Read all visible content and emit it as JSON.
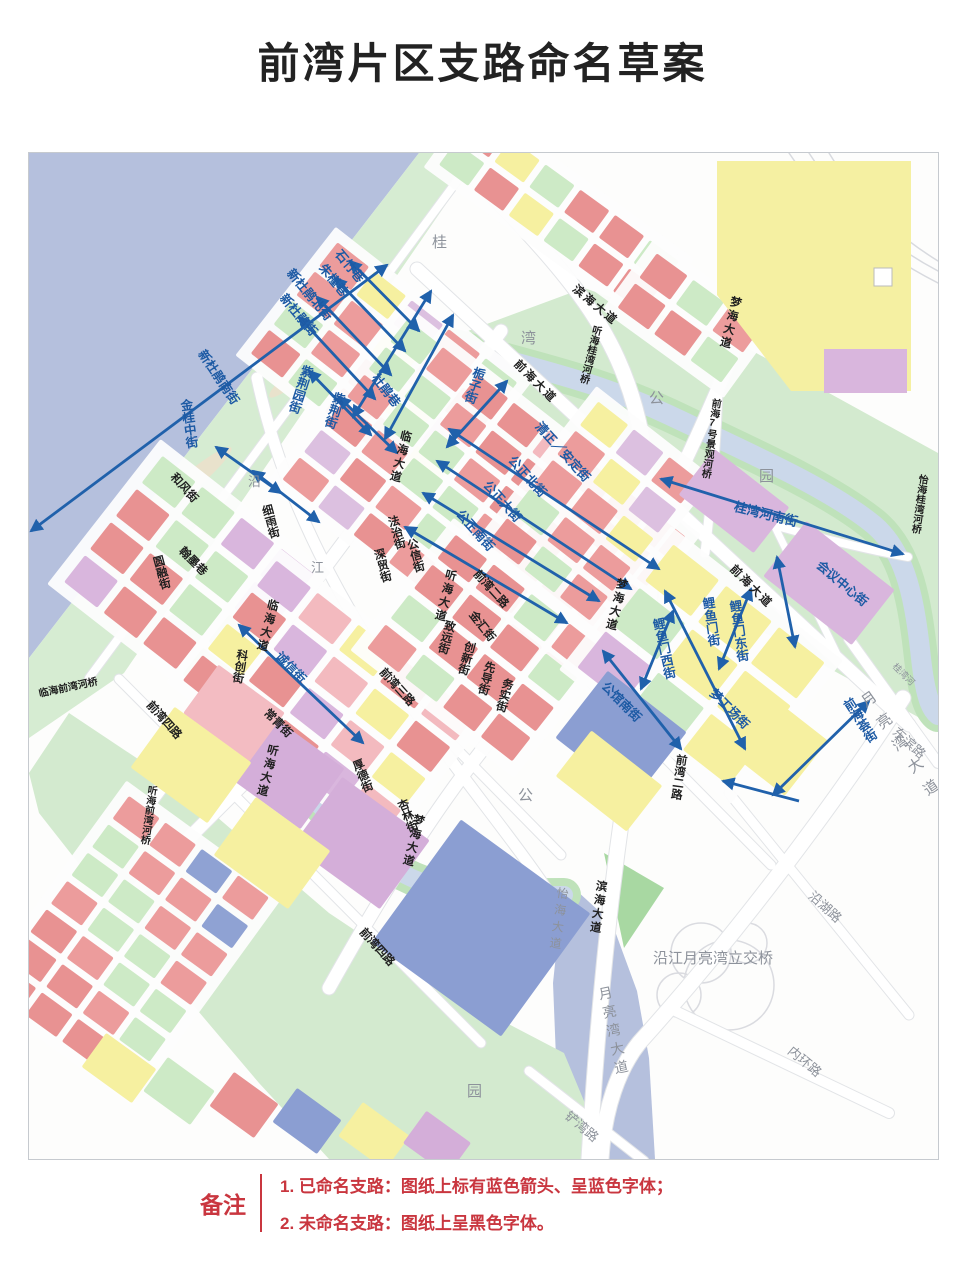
{
  "title": "前湾片区支路命名草案",
  "notes": {
    "label": "备注",
    "items": [
      "1. 已命名支路：图纸上标有蓝色箭头、呈蓝色字体；",
      "2. 未命名支路：图纸上呈黑色字体。"
    ]
  },
  "colors": {
    "named_road_text": "#1d5aa4",
    "arrow_blue": "#2061ab",
    "unnamed_road_text": "#1f1f1f",
    "existing_road_text": "#8d929b",
    "note_red": "#c9363f",
    "sea": "#b5c0dd",
    "park_green": "#d3eacf",
    "block_red": "#e89292",
    "block_yellow": "#f6f0a0",
    "block_purple": "#d9b6dd",
    "block_blue": "#8b9ed2"
  },
  "map": {
    "offset_x": 28,
    "offset_y": 152,
    "width": 909,
    "height": 1006,
    "labels": [
      {
        "t": "石竹巷",
        "x": 341,
        "y": 247,
        "r": 50,
        "c": "n"
      },
      {
        "t": "朱槿巷",
        "x": 325,
        "y": 261,
        "r": 50,
        "c": "n"
      },
      {
        "t": "新杜鹃北街",
        "x": 293,
        "y": 266,
        "r": 50,
        "c": "n"
      },
      {
        "t": "新杜鹃街",
        "x": 286,
        "y": 291,
        "r": 50,
        "c": "n"
      },
      {
        "t": "新杜鹃南街",
        "x": 205,
        "y": 347,
        "r": 56,
        "c": "n"
      },
      {
        "t": "金桂中街",
        "x": 177,
        "y": 398,
        "r": -8,
        "c": "n",
        "m": "v"
      },
      {
        "t": "紫荆园街",
        "x": 300,
        "y": 364,
        "r": 18,
        "c": "n",
        "m": "v"
      },
      {
        "t": "紫荆街",
        "x": 332,
        "y": 391,
        "r": 18,
        "c": "n",
        "m": "v"
      },
      {
        "t": "杜鹃巷",
        "x": 378,
        "y": 371,
        "r": 52,
        "c": "n"
      },
      {
        "t": "栀子街",
        "x": 472,
        "y": 366,
        "r": 18,
        "c": "n",
        "m": "v"
      },
      {
        "t": "清正／安定街",
        "x": 541,
        "y": 419,
        "r": 48,
        "c": "n"
      },
      {
        "t": "公正北街",
        "x": 514,
        "y": 453,
        "r": 48,
        "c": "n"
      },
      {
        "t": "公正大街",
        "x": 489,
        "y": 478,
        "r": 48,
        "c": "n"
      },
      {
        "t": "公正南街",
        "x": 462,
        "y": 507,
        "r": 48,
        "c": "n"
      },
      {
        "t": "诚信街",
        "x": 281,
        "y": 649,
        "r": 46,
        "c": "n"
      },
      {
        "t": "桂湾河南街",
        "x": 735,
        "y": 499,
        "r": 14,
        "c": "n",
        "s": 13
      },
      {
        "t": "会议中心街",
        "x": 821,
        "y": 558,
        "r": 40,
        "c": "n"
      },
      {
        "t": "鲤鱼门西街",
        "x": 649,
        "y": 617,
        "r": -12,
        "c": "n",
        "m": "v"
      },
      {
        "t": "鲤鱼门街",
        "x": 699,
        "y": 596,
        "r": -8,
        "c": "n",
        "m": "v"
      },
      {
        "t": "鲤鱼门东街",
        "x": 726,
        "y": 599,
        "r": -8,
        "c": "n",
        "m": "v"
      },
      {
        "t": "公馆南街",
        "x": 607,
        "y": 679,
        "r": 45,
        "c": "n"
      },
      {
        "t": "梦工场街",
        "x": 715,
        "y": 686,
        "r": 45,
        "c": "n"
      },
      {
        "t": "前海荟街",
        "x": 838,
        "y": 699,
        "r": -33,
        "c": "n",
        "m": "v"
      },
      {
        "t": "和风街",
        "x": 175,
        "y": 471,
        "r": 48,
        "c": "u"
      },
      {
        "t": "细雨街",
        "x": 258,
        "y": 504,
        "r": -15,
        "c": "u",
        "m": "v"
      },
      {
        "t": "翰墨巷",
        "x": 183,
        "y": 545,
        "r": 45,
        "c": "u"
      },
      {
        "t": "圆融街",
        "x": 149,
        "y": 555,
        "r": -15,
        "c": "u",
        "m": "v"
      },
      {
        "t": "法治街",
        "x": 384,
        "y": 515,
        "r": -15,
        "c": "u",
        "m": "v"
      },
      {
        "t": "深贸街",
        "x": 370,
        "y": 548,
        "r": -15,
        "c": "u",
        "m": "v"
      },
      {
        "t": "公信街",
        "x": 403,
        "y": 538,
        "r": -15,
        "c": "u",
        "m": "v"
      },
      {
        "t": "金汇街",
        "x": 474,
        "y": 609,
        "r": 52,
        "c": "u"
      },
      {
        "t": "致远街",
        "x": 443,
        "y": 619,
        "r": 15,
        "c": "u",
        "m": "v"
      },
      {
        "t": "创新街",
        "x": 463,
        "y": 640,
        "r": 15,
        "c": "u",
        "m": "v"
      },
      {
        "t": "先导街",
        "x": 483,
        "y": 660,
        "r": 15,
        "c": "u",
        "m": "v"
      },
      {
        "t": "务实街",
        "x": 501,
        "y": 677,
        "r": 15,
        "c": "u",
        "m": "v"
      },
      {
        "t": "科创街",
        "x": 235,
        "y": 648,
        "r": 10,
        "c": "u",
        "m": "v"
      },
      {
        "t": "常青街",
        "x": 268,
        "y": 707,
        "r": 45,
        "c": "u"
      },
      {
        "t": "厚德街",
        "x": 348,
        "y": 759,
        "r": -22,
        "c": "u",
        "m": "v"
      },
      {
        "t": "杏林街",
        "x": 393,
        "y": 799,
        "r": -22,
        "c": "u",
        "m": "v"
      },
      {
        "t": "前湾二路",
        "x": 478,
        "y": 568,
        "r": 48,
        "c": "u"
      },
      {
        "t": "前湾二路",
        "x": 674,
        "y": 753,
        "r": 8,
        "c": "u",
        "m": "v"
      },
      {
        "t": "前湾三路",
        "x": 384,
        "y": 666,
        "r": 48,
        "c": "u"
      },
      {
        "t": "前湾四路",
        "x": 151,
        "y": 699,
        "r": 48,
        "c": "u"
      },
      {
        "t": "前湾四路",
        "x": 364,
        "y": 926,
        "r": 48,
        "c": "u"
      },
      {
        "t": "临海大道",
        "x": 399,
        "y": 429,
        "r": 14,
        "c": "u",
        "m": "v",
        "ls": 0.2
      },
      {
        "t": "临海大道",
        "x": 266,
        "y": 598,
        "r": 14,
        "c": "u",
        "m": "v",
        "ls": 0.2
      },
      {
        "t": "听海大道",
        "x": 444,
        "y": 568,
        "r": 14,
        "c": "u",
        "m": "v",
        "ls": 0.2
      },
      {
        "t": "听海大道",
        "x": 266,
        "y": 743,
        "r": 14,
        "c": "u",
        "m": "v",
        "ls": 0.2
      },
      {
        "t": "前海大道",
        "x": 518,
        "y": 358,
        "r": 45,
        "c": "u",
        "ls": 0.2
      },
      {
        "t": "前海大道",
        "x": 734,
        "y": 563,
        "r": 45,
        "c": "u",
        "ls": 0.2
      },
      {
        "t": "梦海大道",
        "x": 729,
        "y": 295,
        "r": 14,
        "c": "u",
        "m": "v",
        "ls": 0.2
      },
      {
        "t": "梦海大道",
        "x": 615,
        "y": 577,
        "r": 14,
        "c": "u",
        "m": "v",
        "ls": 0.2
      },
      {
        "t": "梦海大道",
        "x": 412,
        "y": 813,
        "r": 14,
        "c": "u",
        "m": "v",
        "ls": 0.2
      },
      {
        "t": "滨海大道",
        "x": 576,
        "y": 283,
        "r": 40,
        "c": "u",
        "ls": 0.2
      },
      {
        "t": "滨海大道",
        "x": 594,
        "y": 879,
        "r": 8,
        "c": "u",
        "m": "v",
        "ls": 0.2
      },
      {
        "t": "听海桂湾河桥",
        "x": 590,
        "y": 324,
        "r": 14,
        "c": "u",
        "m": "v",
        "s": 10
      },
      {
        "t": "怡海桂湾河桥",
        "x": 916,
        "y": 473,
        "r": 8,
        "c": "u",
        "m": "v",
        "s": 10
      },
      {
        "t": "前海7号景观河桥",
        "x": 709,
        "y": 397,
        "r": 8,
        "c": "u",
        "m": "v",
        "s": 10
      },
      {
        "t": "临海前湾河桥",
        "x": 37,
        "y": 689,
        "r": -12,
        "c": "u",
        "s": 10
      },
      {
        "t": "听海前湾河桥",
        "x": 145,
        "y": 784,
        "r": 8,
        "c": "u",
        "m": "v",
        "s": 10
      },
      {
        "t": "桂",
        "x": 431,
        "y": 234,
        "r": 0,
        "c": "e",
        "s": 15
      },
      {
        "t": "湾",
        "x": 520,
        "y": 330,
        "r": 0,
        "c": "e",
        "s": 15
      },
      {
        "t": "公",
        "x": 648,
        "y": 390,
        "r": 0,
        "c": "e",
        "s": 15
      },
      {
        "t": "园",
        "x": 758,
        "y": 468,
        "r": 0,
        "c": "e",
        "s": 15
      },
      {
        "t": "公",
        "x": 517,
        "y": 787,
        "r": 0,
        "c": "e",
        "s": 15
      },
      {
        "t": "园",
        "x": 466,
        "y": 1083,
        "r": 0,
        "c": "e",
        "s": 15
      },
      {
        "t": "沿",
        "x": 247,
        "y": 474,
        "r": 0,
        "c": "e",
        "s": 13
      },
      {
        "t": "江",
        "x": 310,
        "y": 560,
        "r": 0,
        "c": "e",
        "s": 13
      },
      {
        "t": "月亮湾大道",
        "x": 855,
        "y": 692,
        "r": -35,
        "c": "e",
        "m": "v",
        "s": 15,
        "ls": 0.8
      },
      {
        "t": "月亮湾大道",
        "x": 596,
        "y": 985,
        "r": -12,
        "c": "e",
        "m": "v",
        "s": 14,
        "ls": 0.35
      },
      {
        "t": "东滨路",
        "x": 898,
        "y": 724,
        "r": 42,
        "c": "e",
        "s": 13
      },
      {
        "t": "沿湖路",
        "x": 814,
        "y": 888,
        "r": 42,
        "c": "e",
        "s": 13
      },
      {
        "t": "内环路",
        "x": 793,
        "y": 1043,
        "r": 40,
        "c": "e",
        "s": 13
      },
      {
        "t": "铲湾路",
        "x": 570,
        "y": 1108,
        "r": 40,
        "c": "e",
        "s": 13
      },
      {
        "t": "怡海大道",
        "x": 556,
        "y": 886,
        "r": 8,
        "c": "e",
        "m": "v",
        "s": 12,
        "ls": 0.4
      },
      {
        "t": "沿江月亮湾立交桥",
        "x": 652,
        "y": 950,
        "r": 0,
        "c": "e",
        "s": 15
      },
      {
        "t": "桂湾河",
        "x": 896,
        "y": 661,
        "r": 45,
        "c": "e",
        "s": 9
      }
    ],
    "arrows": [
      {
        "x1": 30,
        "y1": 530,
        "x2": 386,
        "y2": 264,
        "d": 1
      },
      {
        "x1": 352,
        "y1": 416,
        "x2": 430,
        "y2": 290,
        "d": 1
      },
      {
        "x1": 384,
        "y1": 438,
        "x2": 452,
        "y2": 314,
        "d": 1
      },
      {
        "x1": 349,
        "y1": 260,
        "x2": 418,
        "y2": 330,
        "d": 1
      },
      {
        "x1": 334,
        "y1": 277,
        "x2": 404,
        "y2": 350,
        "d": 1
      },
      {
        "x1": 316,
        "y1": 296,
        "x2": 390,
        "y2": 374,
        "d": 1
      },
      {
        "x1": 298,
        "y1": 316,
        "x2": 374,
        "y2": 398,
        "d": 1
      },
      {
        "x1": 308,
        "y1": 370,
        "x2": 370,
        "y2": 434,
        "d": 1
      },
      {
        "x1": 338,
        "y1": 396,
        "x2": 396,
        "y2": 452,
        "d": 1
      },
      {
        "x1": 215,
        "y1": 446,
        "x2": 280,
        "y2": 492,
        "d": 1
      },
      {
        "x1": 252,
        "y1": 470,
        "x2": 318,
        "y2": 521,
        "d": 1
      },
      {
        "x1": 446,
        "y1": 446,
        "x2": 506,
        "y2": 380,
        "d": 1
      },
      {
        "x1": 448,
        "y1": 428,
        "x2": 658,
        "y2": 568,
        "d": 1
      },
      {
        "x1": 436,
        "y1": 460,
        "x2": 630,
        "y2": 588,
        "d": 1
      },
      {
        "x1": 422,
        "y1": 492,
        "x2": 598,
        "y2": 600,
        "d": 1
      },
      {
        "x1": 404,
        "y1": 526,
        "x2": 566,
        "y2": 622,
        "d": 1
      },
      {
        "x1": 238,
        "y1": 624,
        "x2": 362,
        "y2": 742,
        "d": 1
      },
      {
        "x1": 660,
        "y1": 478,
        "x2": 902,
        "y2": 553,
        "d": 1
      },
      {
        "x1": 776,
        "y1": 556,
        "x2": 794,
        "y2": 646,
        "d": 1
      },
      {
        "x1": 640,
        "y1": 688,
        "x2": 672,
        "y2": 610,
        "d": 1
      },
      {
        "x1": 718,
        "y1": 668,
        "x2": 750,
        "y2": 588,
        "d": 1
      },
      {
        "x1": 602,
        "y1": 650,
        "x2": 680,
        "y2": 748,
        "d": 1
      },
      {
        "x1": 664,
        "y1": 590,
        "x2": 744,
        "y2": 748,
        "d": 1
      },
      {
        "x1": 772,
        "y1": 794,
        "x2": 868,
        "y2": 700,
        "d": 1
      },
      {
        "x1": 798,
        "y1": 800,
        "x2": 722,
        "y2": 780,
        "d": 0
      }
    ]
  }
}
